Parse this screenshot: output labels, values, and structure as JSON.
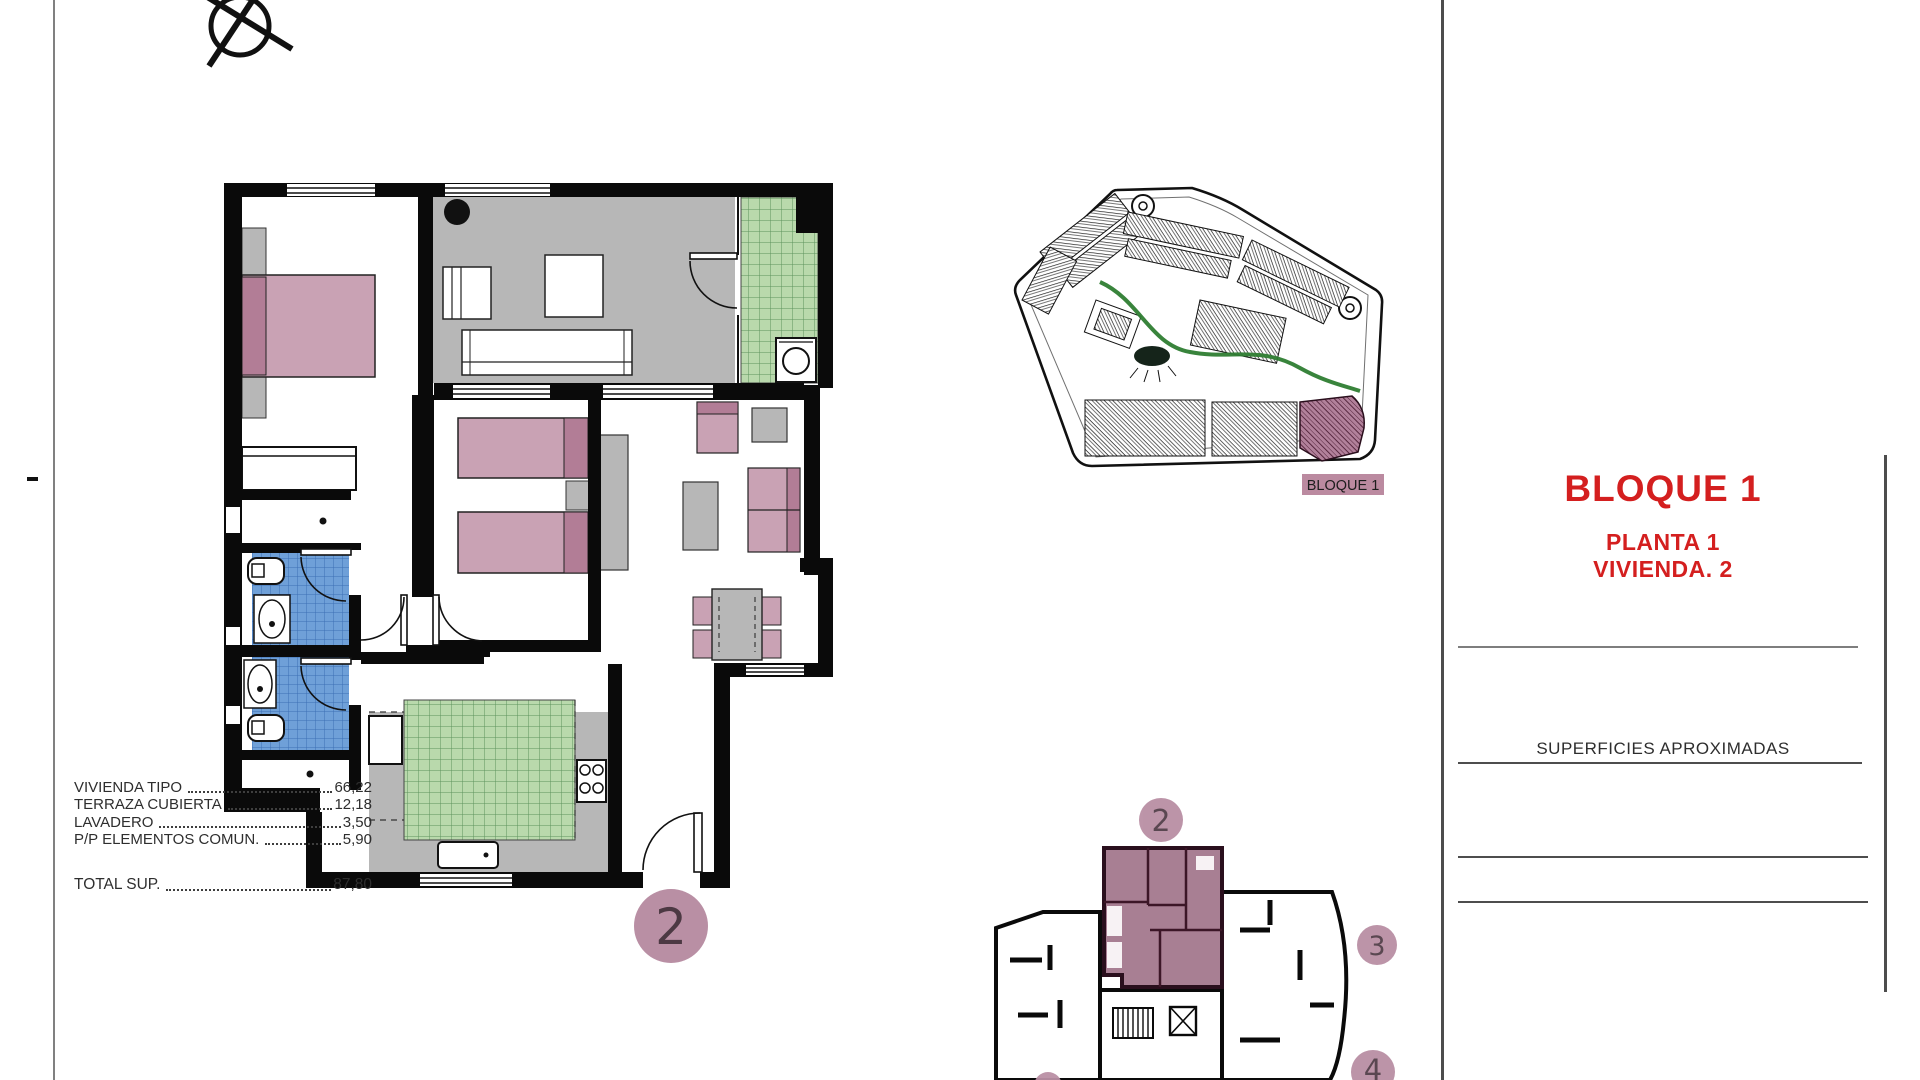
{
  "title_block": {
    "title": "BLOQUE 1",
    "line1": "PLANTA 1",
    "line2": "VIVIENDA. 2"
  },
  "surfaces": {
    "header": "SUPERFICIES APROXIMADAS",
    "rows": [
      {
        "label": "VIVIENDA TIPO",
        "value": "66,22"
      },
      {
        "label": "TERRAZA CUBIERTA",
        "value": "12,18"
      },
      {
        "label": "LAVADERO",
        "value": "3,50"
      },
      {
        "label": "P/P ELEMENTOS COMUN.",
        "value": "5,90"
      }
    ],
    "total": {
      "label": "TOTAL SUP.",
      "value": "87,80"
    }
  },
  "site_plan": {
    "label": "BLOQUE 1"
  },
  "unit_badge": "2",
  "key_plan": {
    "unit2": "2",
    "unit3": "3",
    "unit4": "4"
  },
  "colors": {
    "accent_red": "#d41f1f",
    "room_pink": "#c9a2b4",
    "pillow_pink": "#b27d96",
    "highlight_mauve": "#a87f93",
    "badge_mauve": "#b98fa4",
    "terrace_gray": "#b7b7b7",
    "tile_green": "#b9d9ac",
    "tile_blue": "#6fa0d8",
    "path_green": "#2e7d32"
  }
}
